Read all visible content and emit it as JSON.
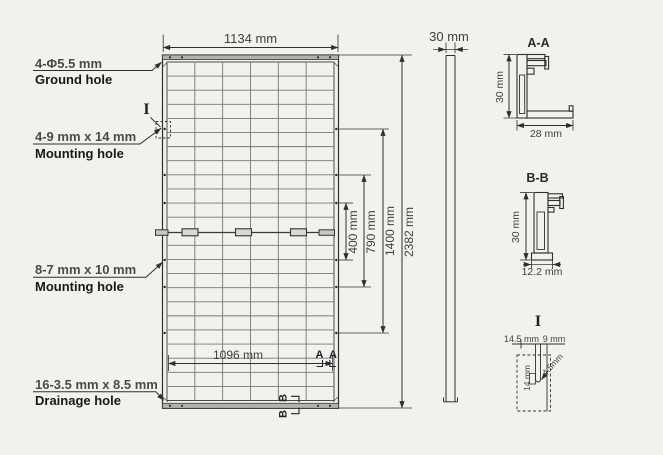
{
  "colors": {
    "background": "#f2f1ee",
    "line": "#2f2f2f",
    "grid_line": "#777777",
    "frame_fill": "#b3b2b0",
    "dim_text": "#4a4a4a",
    "label_text": "#181818"
  },
  "callouts": [
    {
      "dim": "4-Φ5.5 mm",
      "name": "Ground hole"
    },
    {
      "dim": "4-9 mm x 14 mm",
      "name": "Mounting hole"
    },
    {
      "dim": "8-7 mm x 10 mm",
      "name": "Mounting hole"
    },
    {
      "dim": "16-3.5 mm x 8.5 mm",
      "name": "Drainage hole"
    }
  ],
  "front_view": {
    "width": "1134 mm",
    "inner_width": "1096 mm",
    "dim_400": "400 mm",
    "dim_790": "790 mm",
    "dim_1400": "1400 mm",
    "dim_2382": "2382 mm",
    "detail_marker": "I",
    "section_a_left": "A",
    "section_a_right": "A",
    "section_b_top": "B",
    "section_b_bottom": "B"
  },
  "side_view": {
    "thickness": "30 mm"
  },
  "section_aa": {
    "title": "A-A",
    "height": "30 mm",
    "width": "28 mm"
  },
  "section_bb": {
    "title": "B-B",
    "height": "30 mm",
    "width": "12.2 mm"
  },
  "detail_i": {
    "title": "I",
    "dim_left": "14.5 mm",
    "dim_right": "9 mm",
    "dim_depth": "14 mm",
    "dim_radius": "4.5mm"
  }
}
